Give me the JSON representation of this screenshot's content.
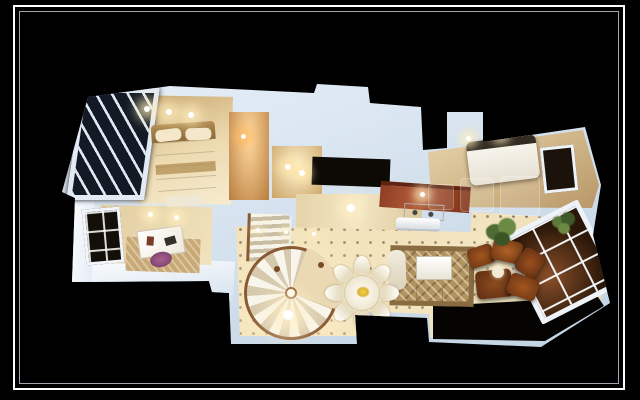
{
  "meta": {
    "type": "3d-floorplan-render",
    "description": "Aerial 3D cutaway rendering of an apartment floor plan with a spiral staircase, shown on a black background inside a thin white double picture frame",
    "text_visible": "none"
  },
  "frame": {
    "outer_color": "#ffffff",
    "inner_color": "#9fa6ad"
  },
  "colors": {
    "bg": "#000000",
    "frame": "#ffffff",
    "frame_inner": "#9fa6ad",
    "wall_hi": "#f0f6fc",
    "wall": "#d8e4f0",
    "wall_lo": "#bccfdf",
    "floor_cream": "#ead9b2",
    "floor_warm": "#cdb183",
    "glow_warm": "#ffeec0",
    "bath_glow": "#ffb95e",
    "kitchen_red": "#9c432a",
    "stove": "#f4f1e9",
    "bed_white": "#faf7f0",
    "bed_gold": "#b08d52",
    "rug": "#b1935f",
    "sofa_white": "#f2ecdd",
    "wood": "#94502a",
    "wood_dark": "#5f2d12",
    "rail": "#8a5a33",
    "glass": "#131a25",
    "plant": "#55703b",
    "purple": "#8e4f7d",
    "window_dark": "#1b130b",
    "wm": "rgba(255,255,255,0.12)"
  },
  "rooms": [
    "balcony-sunroom",
    "master-bedroom",
    "bathroom-a",
    "bathroom-b",
    "hallway",
    "kitchen",
    "second-bedroom",
    "living-room",
    "dining-area",
    "study",
    "terrace",
    "stairwell",
    "french-door-room"
  ],
  "furniture": [
    "master-bed",
    "second-bed",
    "spiral-staircase",
    "round-dining-table",
    "dining-chairs-x8",
    "white-sofa",
    "coffee-table",
    "area-rug",
    "wood-lounge-set",
    "study-desk",
    "office-chair",
    "stove",
    "air-conditioner",
    "potted-plants"
  ],
  "watermark": {
    "present": true,
    "legible": false
  }
}
